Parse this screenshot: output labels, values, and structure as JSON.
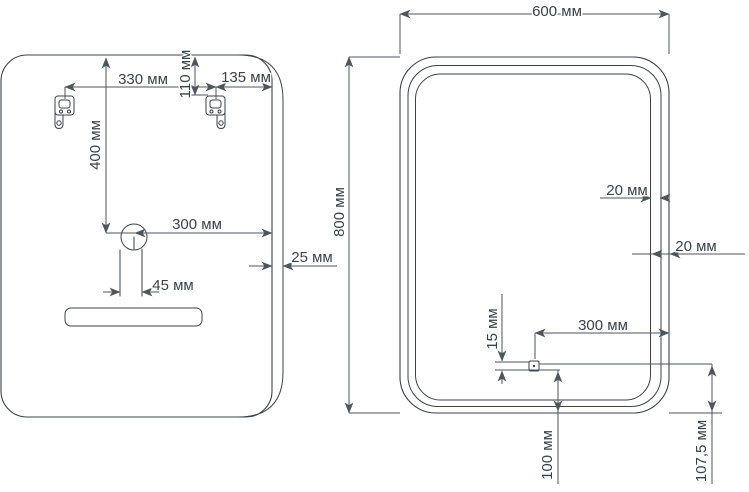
{
  "colors": {
    "line": "#3b4248",
    "dim": "#4d565c",
    "text": "#39434b",
    "background": "#ffffff"
  },
  "units": "мм",
  "back_view": {
    "dim_bracket_spacing": "330 мм",
    "dim_bracket_to_edge": "135 мм",
    "dim_brackets_from_top": "110 мм",
    "dim_hole_from_top": "400 мм",
    "dim_hole_to_right_edge": "300 мм",
    "dim_cable_outlet_width": "45 мм",
    "dim_thickness": "25 мм"
  },
  "front_view": {
    "dim_width": "600 мм",
    "dim_height": "800 мм",
    "dim_led_strip_width": "20 мм",
    "dim_led_edge_offset": "20 мм",
    "dim_sensor_to_right_edge": "300 мм",
    "dim_sensor_height": "15 мм",
    "dim_sensor_from_bottom": "100 мм",
    "dim_sensor_center_from_bottom": "107,5 мм"
  }
}
